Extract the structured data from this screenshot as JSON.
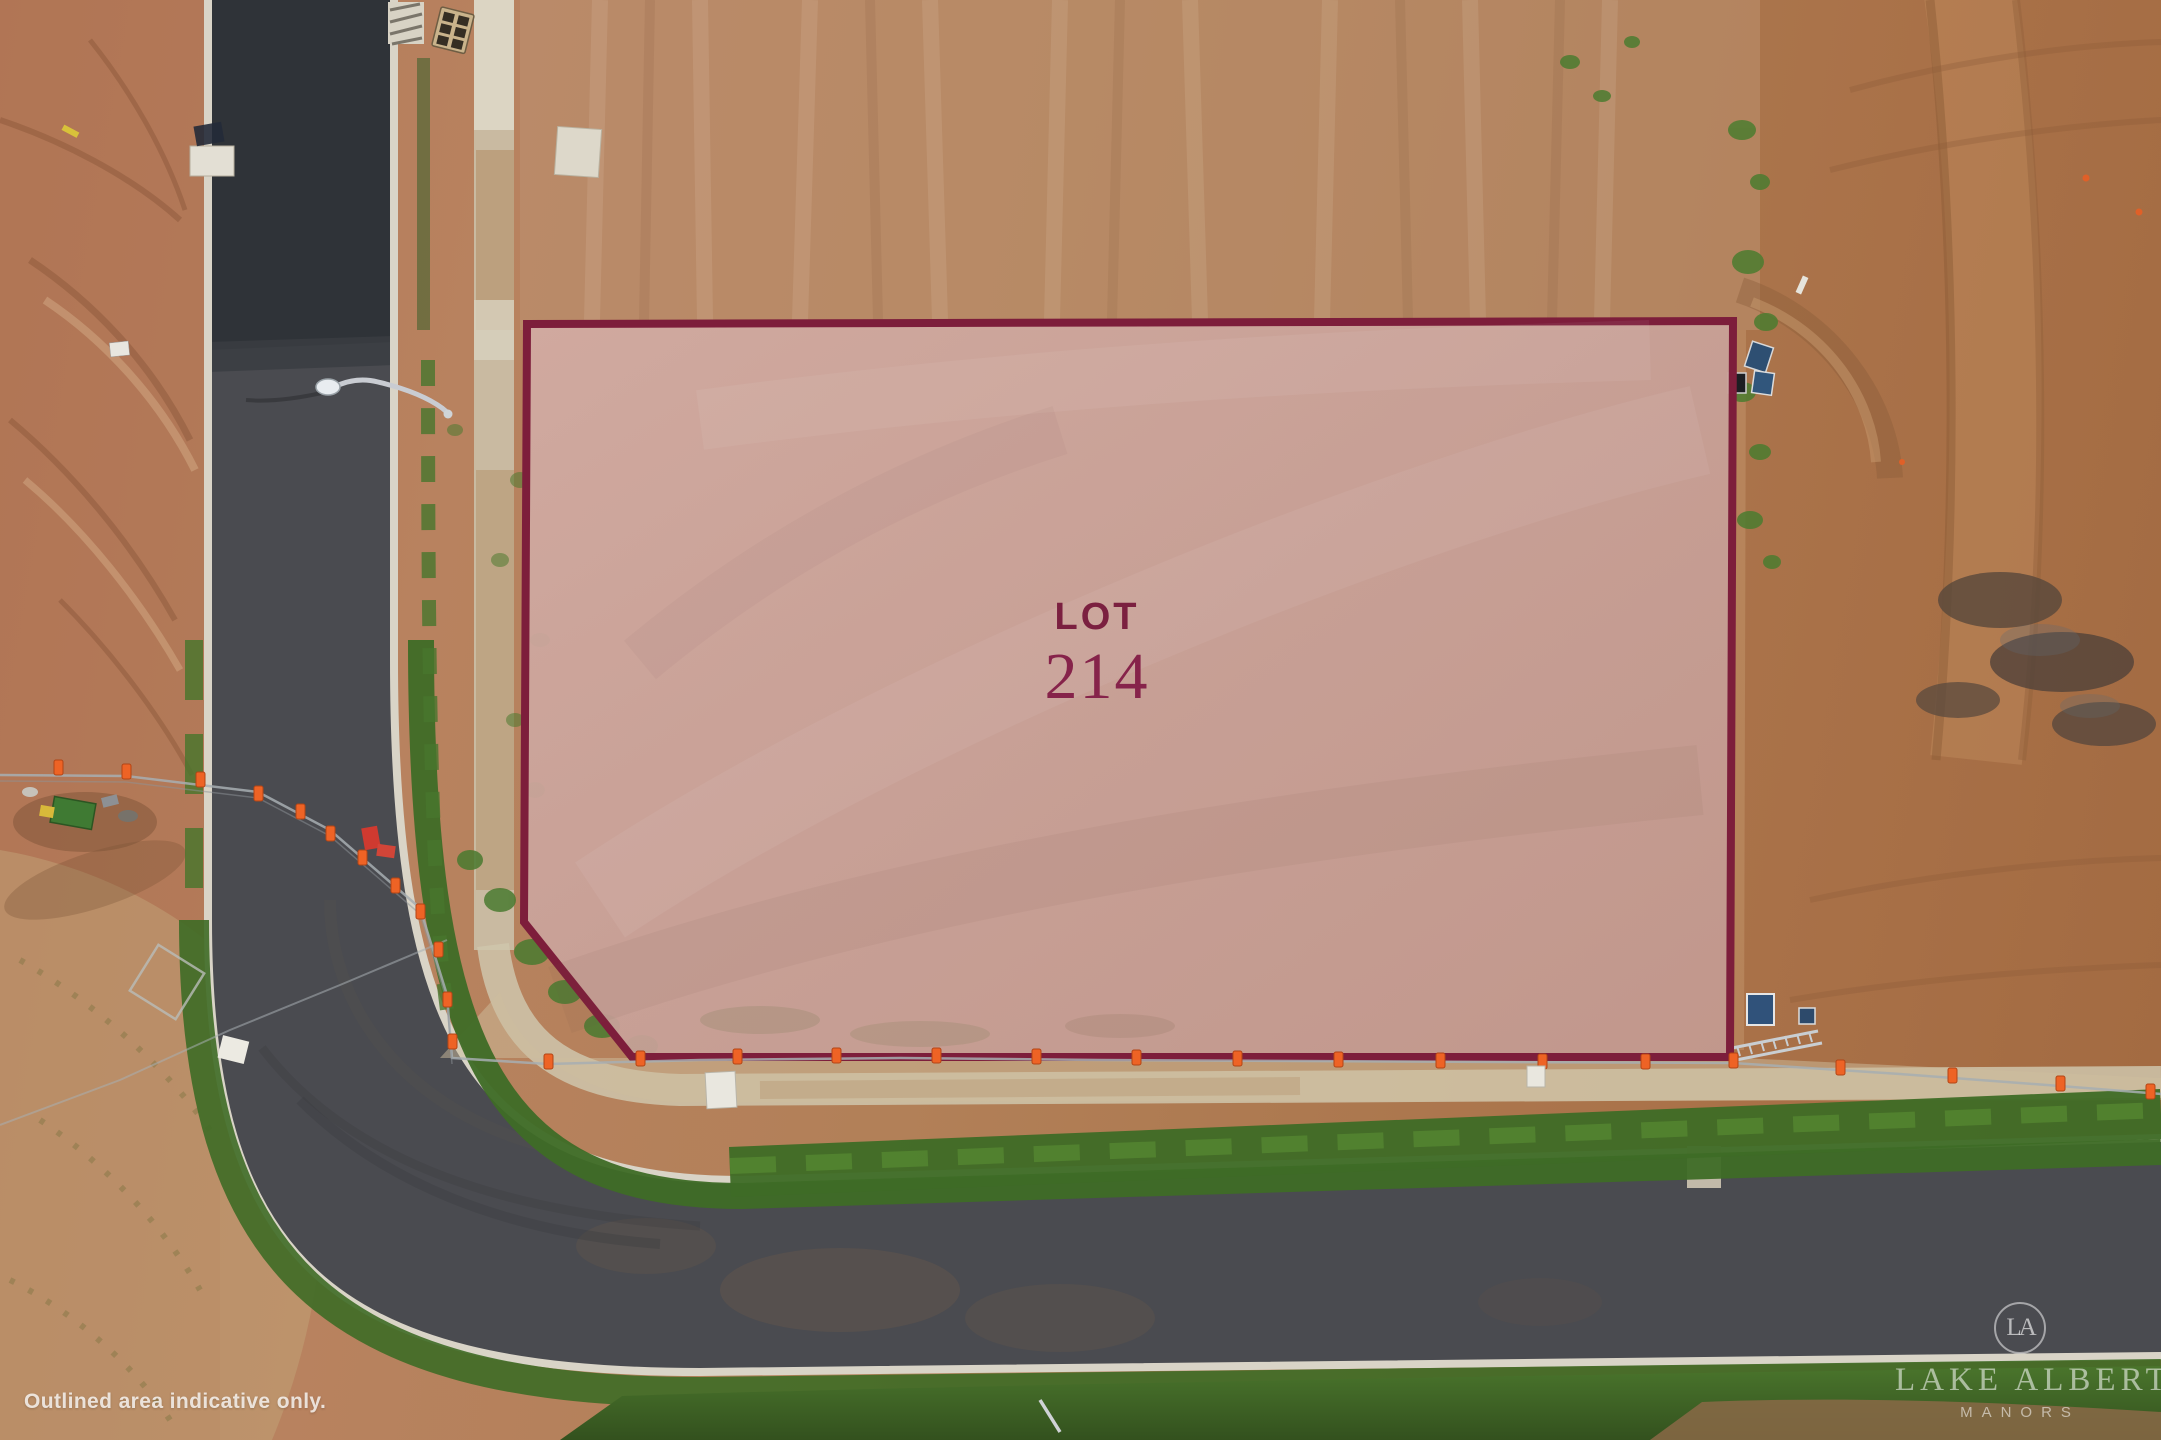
{
  "lot_overlay": {
    "label": "LOT",
    "number": "214"
  },
  "disclaimer": {
    "text": "Outlined area indicative only."
  },
  "watermark": {
    "monogram": "LA",
    "name": "LAKE ALBERT",
    "subtitle": "MANORS"
  },
  "palette": {
    "lot_outline": "#7d1e3b",
    "lot_fill": "#cba49c",
    "lot_text": "#7b2040",
    "asphalt_new": "#2d3136",
    "asphalt": "#4a4b50",
    "kerb_concrete": "#d9d4c7",
    "footpath": "#cbc0a8",
    "grass_verge": "#3e6b26",
    "dirt_west": "#b47a5a",
    "dirt_east": "#a76f48",
    "safety_cone": "#ee6325",
    "watermark_text": "rgba(255,255,255,0.6)"
  }
}
